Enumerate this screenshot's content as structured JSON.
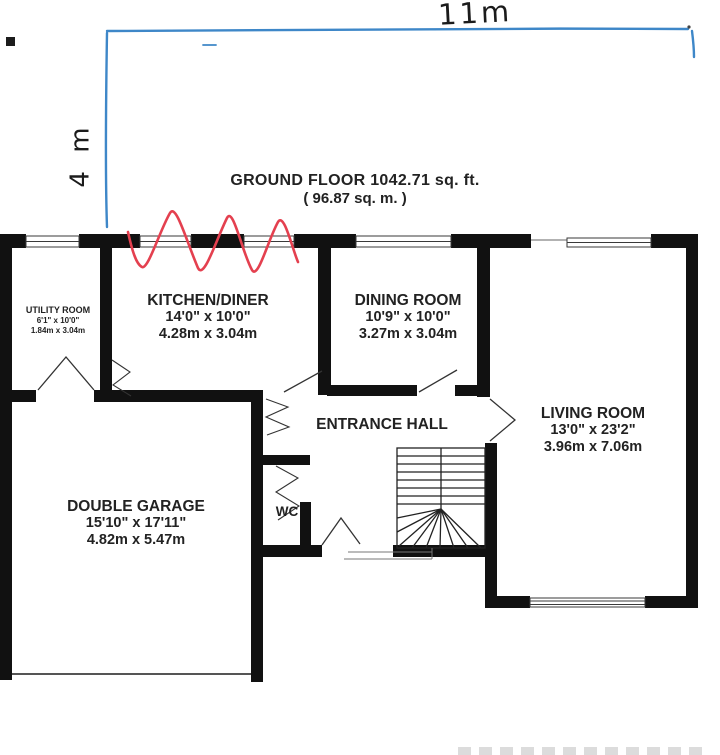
{
  "floorplan": {
    "title_line1": "GROUND FLOOR 1042.71 sq. ft.",
    "title_line2": "( 96.87 sq. m. )",
    "rooms": {
      "utility": {
        "name": "UTILITY ROOM",
        "imperial": "6'1\" x 10'0\"",
        "metric": "1.84m x 3.04m"
      },
      "kitchen": {
        "name": "KITCHEN/DINER",
        "imperial": "14'0\" x 10'0\"",
        "metric": "4.28m x 3.04m"
      },
      "dining": {
        "name": "DINING ROOM",
        "imperial": "10'9\" x 10'0\"",
        "metric": "3.27m x 3.04m"
      },
      "living": {
        "name": "LIVING ROOM",
        "imperial": "13'0\" x 23'2\"",
        "metric": "3.96m x 7.06m"
      },
      "garage": {
        "name": "DOUBLE GARAGE",
        "imperial": "15'10\" x 17'11\"",
        "metric": "4.82m x 5.47m"
      },
      "hall": {
        "name": "ENTRANCE HALL"
      },
      "wc": {
        "name": "WC"
      }
    },
    "annotations": {
      "width_label": "11m",
      "height_label": "4 m",
      "pen_line_color": "#3e87c8",
      "marker_color": "#e4404f"
    },
    "wall_color": "#111111"
  }
}
